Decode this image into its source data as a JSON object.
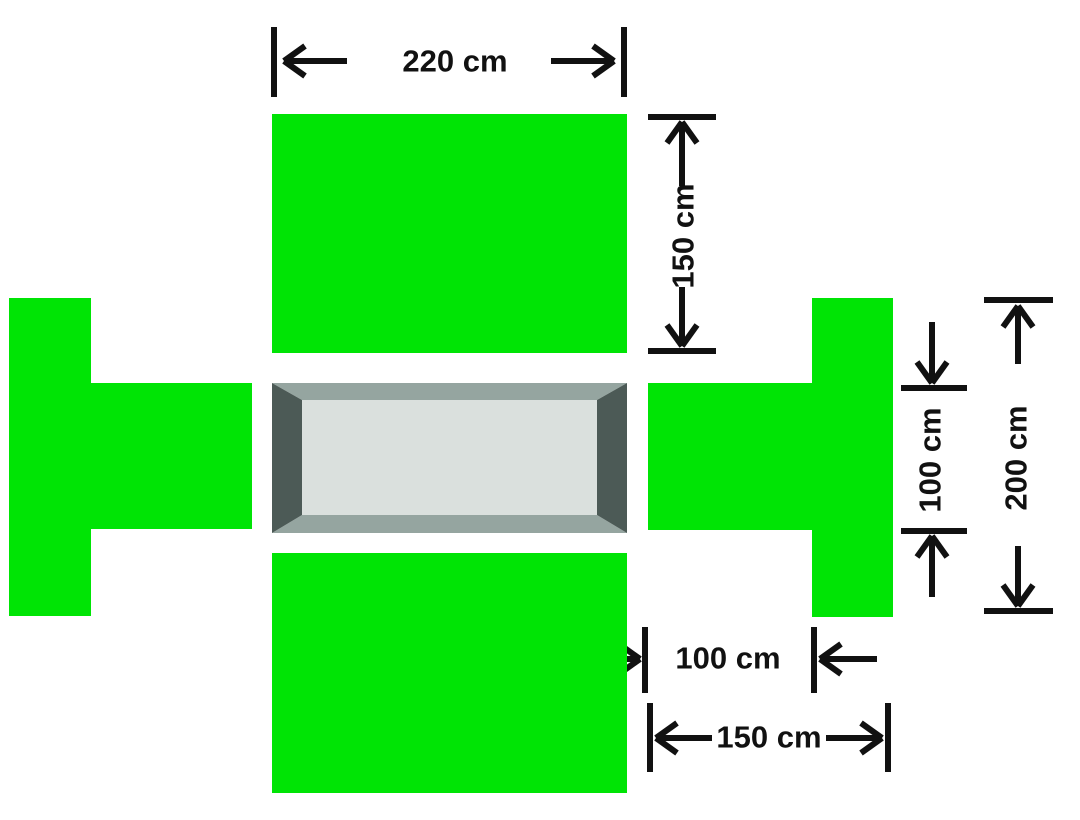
{
  "colors": {
    "background": "#ffffff",
    "rug_green": "#00e405",
    "ink": "#111111",
    "table_bevel_light": "#95a5a0",
    "table_bevel_dark": "#4c5a56",
    "table_surface": "#dae0dd"
  },
  "labels": {
    "top_width": "220 cm",
    "top_rug_depth": "150 cm",
    "right_opening_height": "100 cm",
    "right_total_height": "200 cm",
    "bottom_opening_width": "100 cm",
    "bottom_total_width": "150 cm"
  },
  "measurements": [
    {
      "position": "top-horizontal",
      "text": "220 cm"
    },
    {
      "position": "upper-right-vertical",
      "text": "150 cm"
    },
    {
      "position": "right-inner-vertical",
      "text": "100 cm"
    },
    {
      "position": "far-right-vertical",
      "text": "200 cm"
    },
    {
      "position": "bottom-inner-horizontal",
      "text": "100 cm"
    },
    {
      "position": "bottom-outer-horizontal",
      "text": "150 cm"
    }
  ]
}
